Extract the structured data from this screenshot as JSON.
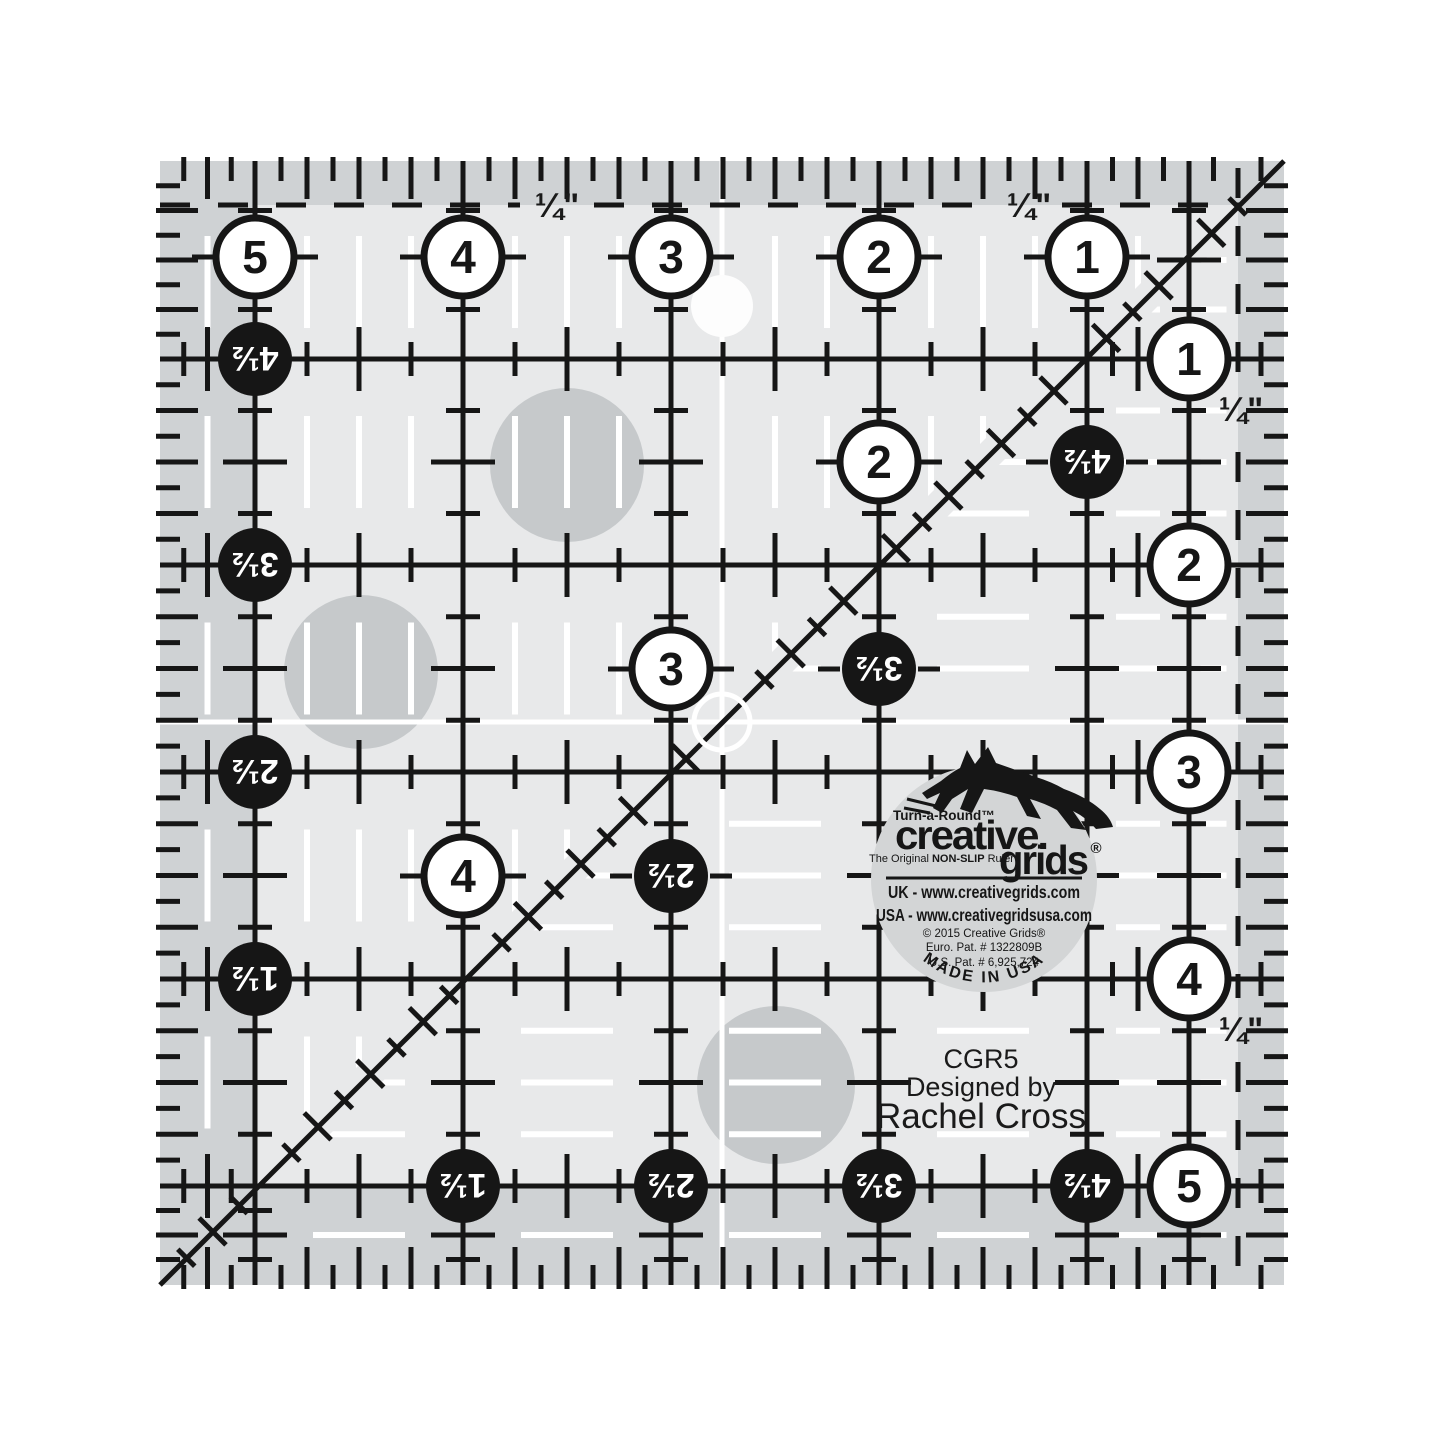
{
  "product": {
    "brand": "Creative Grids",
    "model": "CGR5",
    "designed_by_label": "Designed by",
    "designer": "Rachel Cross"
  },
  "logo": {
    "tagline": "Turn-a-Round™",
    "brand_word1": "creative.",
    "brand_word2": "grids",
    "registered_mark": "®",
    "subtitle_prefix": "The Original ",
    "subtitle_bold": "NON-SLIP",
    "subtitle_suffix": " Ruler",
    "url_uk": "UK - www.creativegrids.com",
    "url_usa": "USA - www.creativegridsusa.com",
    "copyright": "© 2015 Creative Grids®",
    "patent_euro": "Euro. Pat. # 1322809B",
    "patent_us": "U.S. Pat. # 6,925,724",
    "made_in": "MADE IN USA"
  },
  "ruler": {
    "quarter_inch_label": "¼\"",
    "white_circles_top": [
      "5",
      "4",
      "3",
      "2",
      "1"
    ],
    "white_circles_right": [
      "1",
      "2",
      "3",
      "4",
      "5"
    ],
    "white_circles_inner": [
      "2",
      "3",
      "4"
    ],
    "black_circles_left": [
      "4½",
      "3½",
      "2½",
      "1½"
    ],
    "black_circles_bottom": [
      "1½",
      "2½",
      "3½",
      "4½"
    ],
    "black_circles_inner": [
      "4½",
      "3½",
      "2½"
    ]
  },
  "colors": {
    "background": "#ffffff",
    "ruler_body": "#e8e9ea",
    "border_band": "#cfd2d4",
    "grip_dot": "#c6c9cb",
    "logo_background": "#d3d5d6",
    "ink_black": "#161616",
    "ink_white": "#ffffff",
    "hole_white": "#fdfdfd"
  }
}
